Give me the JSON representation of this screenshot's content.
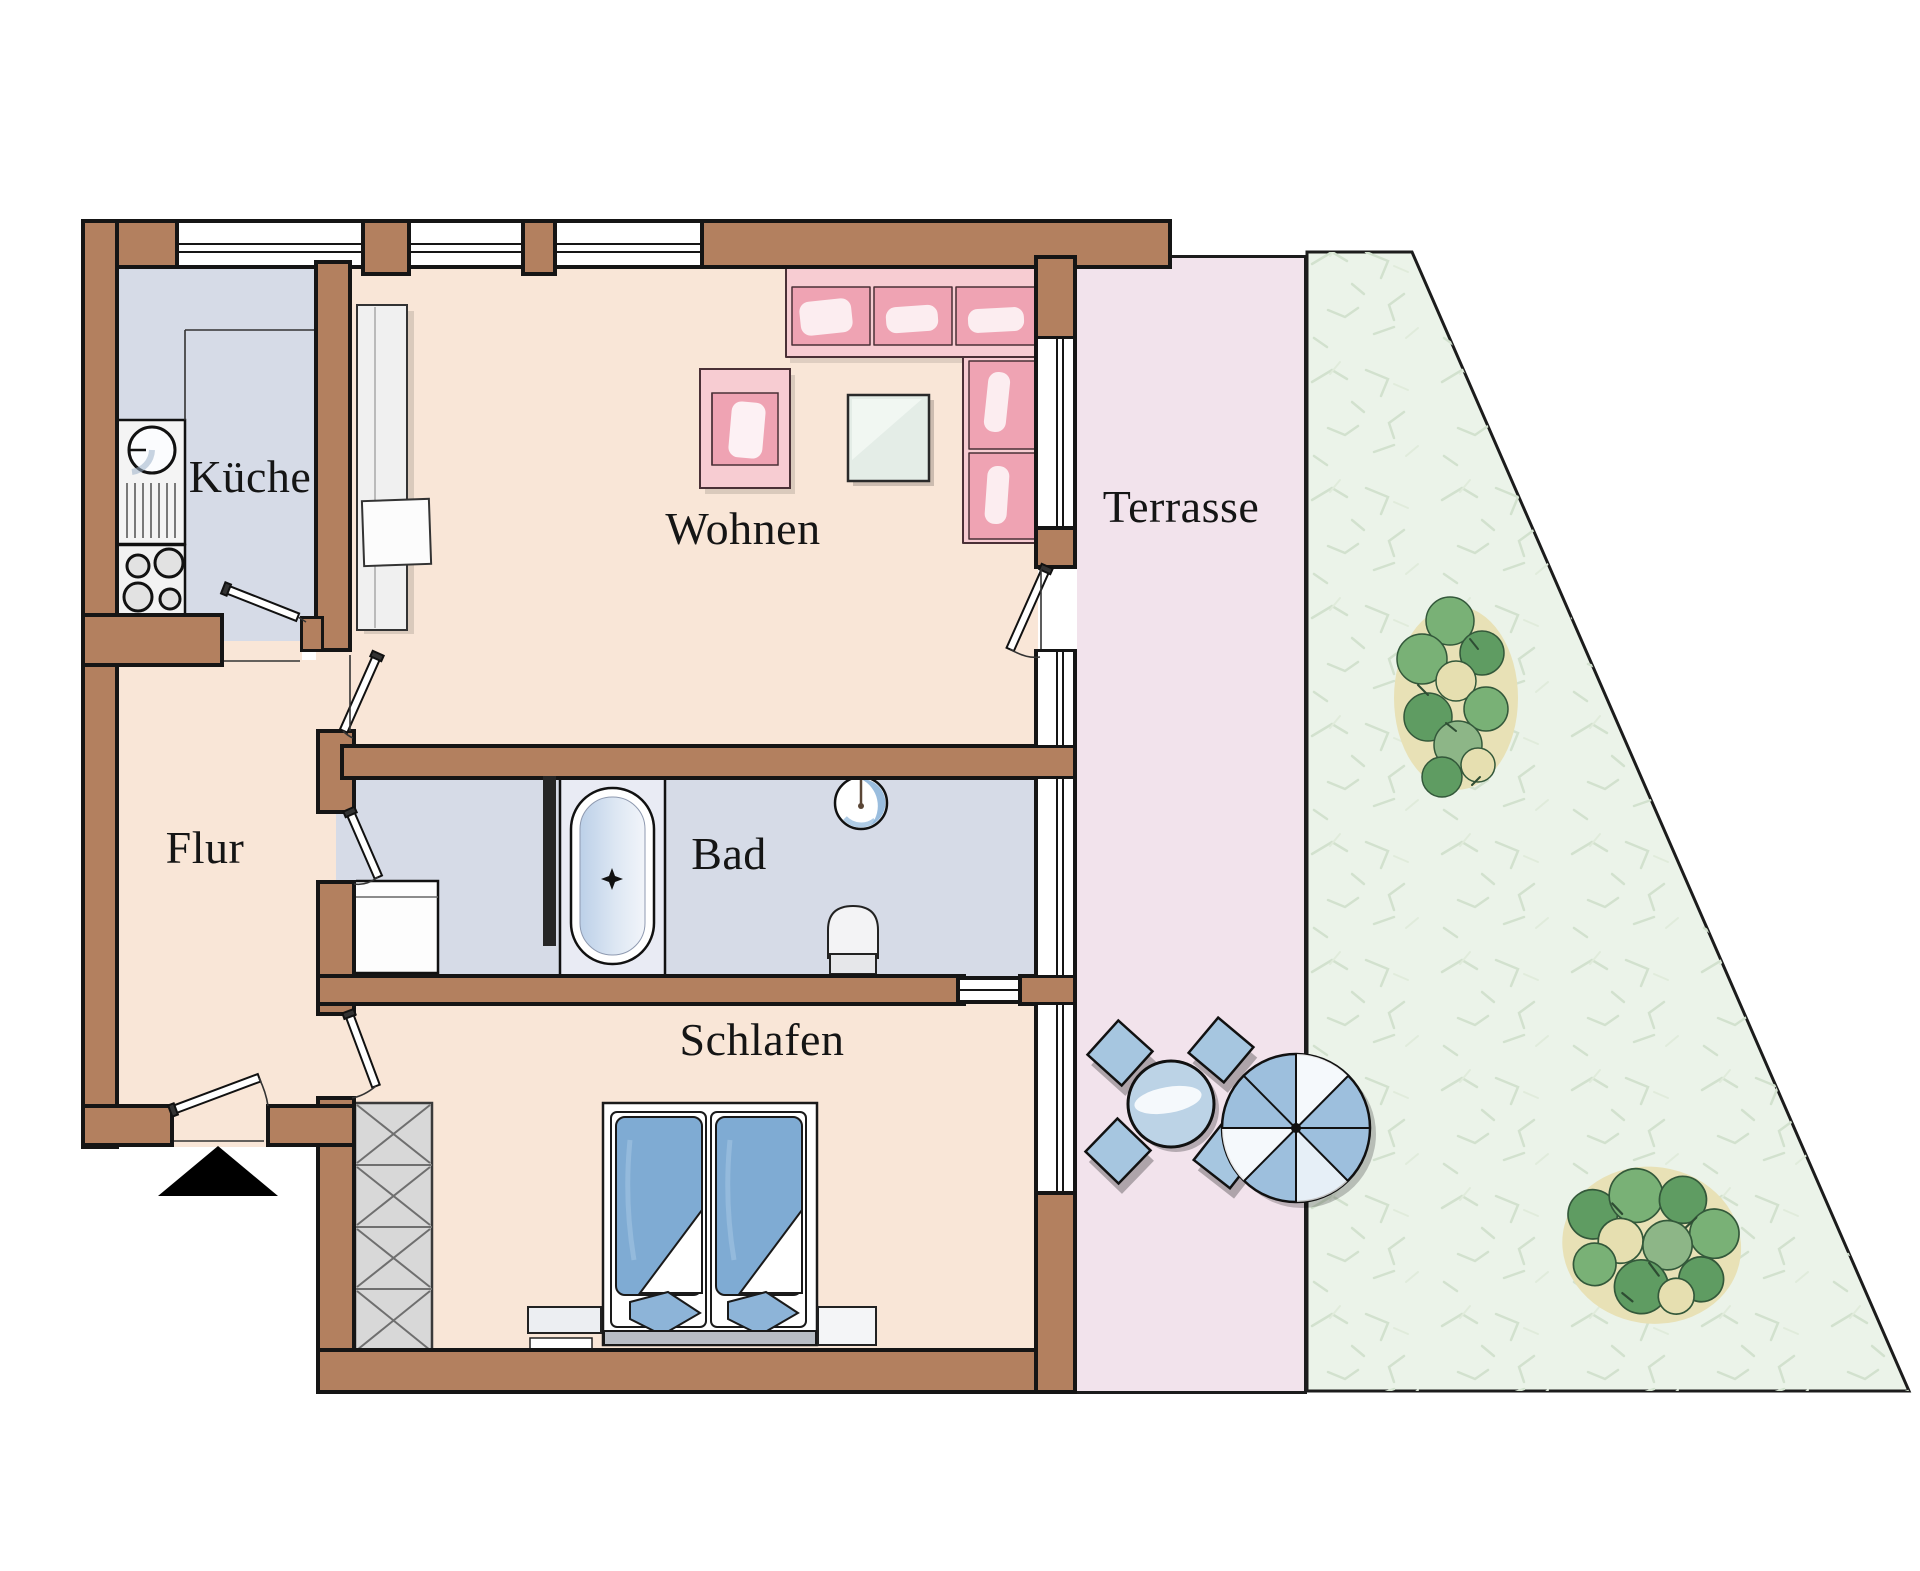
{
  "plan": {
    "rooms": {
      "kueche": {
        "label": "Küche"
      },
      "wohnen": {
        "label": "Wohnen"
      },
      "flur": {
        "label": "Flur"
      },
      "bad": {
        "label": "Bad"
      },
      "schlafen": {
        "label": "Schlafen"
      },
      "terrasse": {
        "label": "Terrasse"
      }
    },
    "colors": {
      "wall_brown": "#b3805f",
      "outline_black": "#151515",
      "living_floor_peach": "#f9e6d7",
      "wet_room_floor_blue": "#d6dbe7",
      "terrace_pink": "#f2e3ec",
      "garden_green": "#ebf3e9",
      "sofa_pink": "#efa3b3",
      "bed_blue": "#7fabd3",
      "furniture_blue": "#a6c6e0"
    },
    "symbols": {
      "entrance_marker": "entrance-triangle-icon"
    }
  }
}
